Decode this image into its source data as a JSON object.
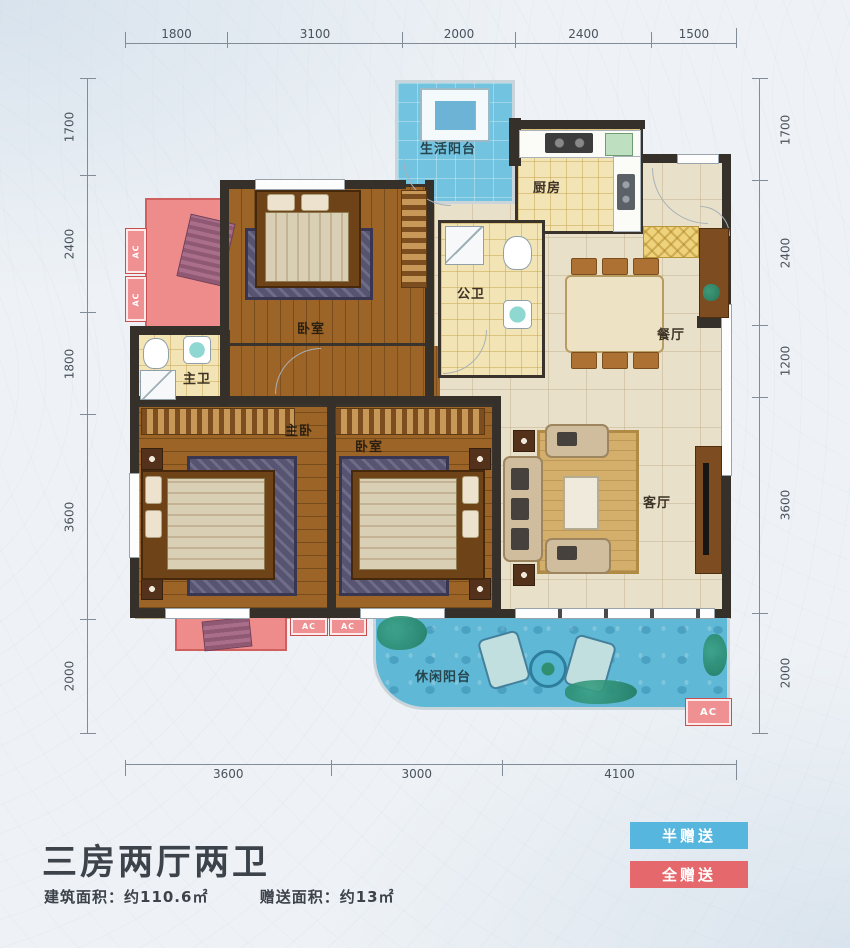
{
  "title": "三房两厅两卫",
  "area": {
    "built": "建筑面积：约110.6㎡",
    "gift": "赠送面积：约13㎡"
  },
  "legend": {
    "half": "半赠送",
    "full": "全赠送"
  },
  "ac_label": "AC",
  "rooms": {
    "life_balcony": "生活阳台",
    "kitchen": "厨房",
    "public_bath": "公卫",
    "dining": "餐厅",
    "bedroom_top": "卧室",
    "master_bath": "主卫",
    "master_bedroom": "主卧",
    "bedroom_mid": "卧室",
    "living": "客厅",
    "leisure_balcony": "休闲阳台"
  },
  "dimensions": {
    "top": [
      "1800",
      "3100",
      "2000",
      "2400",
      "1500"
    ],
    "left": [
      "1700",
      "2400",
      "1800",
      "3600",
      "2000"
    ],
    "right": [
      "1700",
      "2400",
      "1200",
      "3600",
      "2000"
    ],
    "bottom": [
      "3600",
      "3000",
      "4100"
    ]
  },
  "colors": {
    "legend_half": "#56b6dd",
    "legend_full": "#e5696c",
    "balcony_blue": "#68bedd",
    "gift_pink": "#ee8c8c",
    "wood": "#9c6527",
    "tile": "#f2e4b4",
    "wall": "#35302a"
  }
}
